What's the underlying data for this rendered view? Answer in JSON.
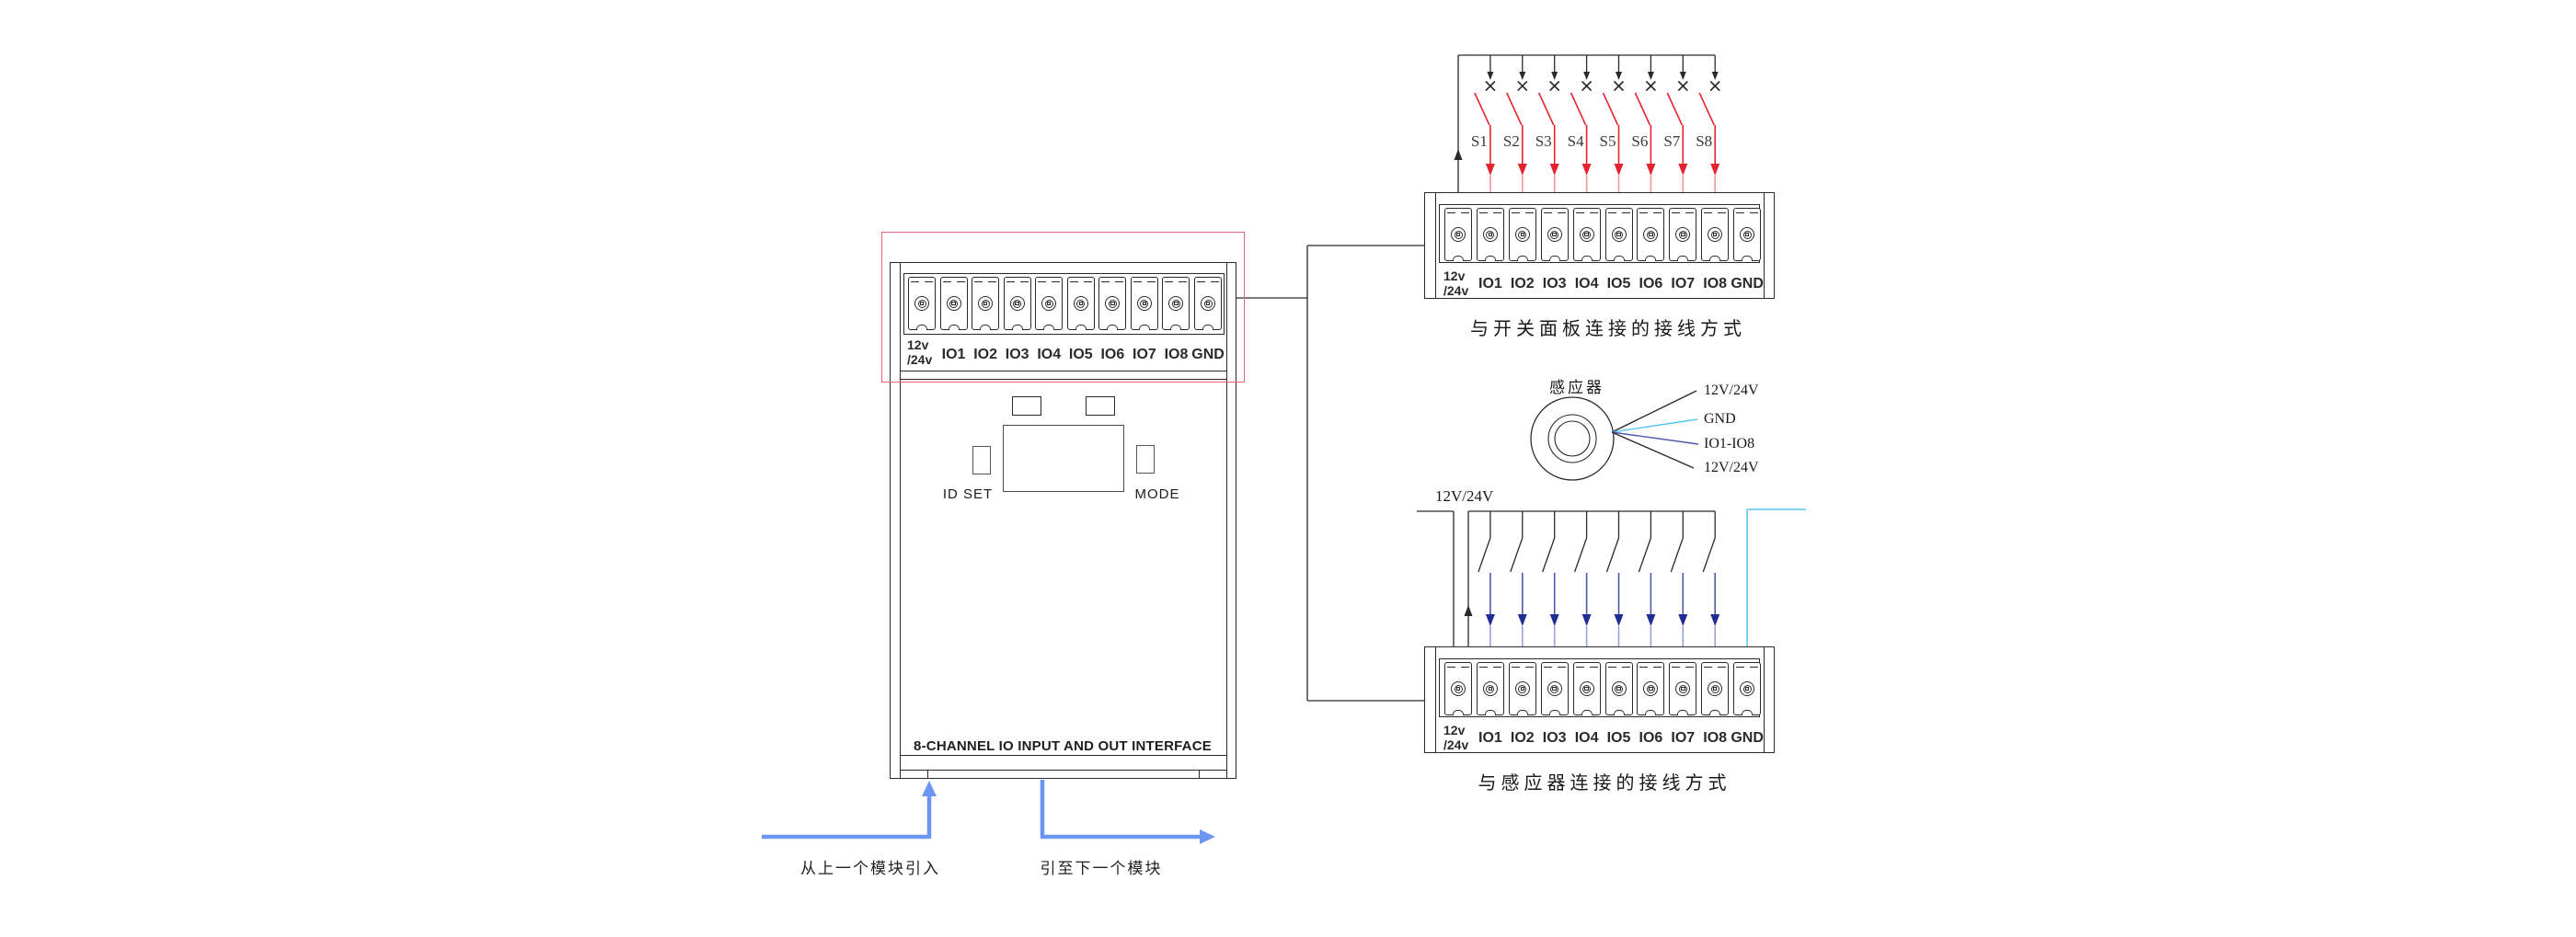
{
  "diagram": {
    "module": {
      "power_label_top": "12v",
      "power_label_bottom": "/24v",
      "io_labels": [
        "IO1",
        "IO2",
        "IO3",
        "IO4",
        "IO5",
        "IO6",
        "IO7",
        "IO8"
      ],
      "gnd_label": "GND",
      "id_set_label": "ID SET",
      "mode_label": "MODE",
      "bottom_label": "8-CHANNEL IO INPUT AND OUT INTERFACE"
    },
    "switch_panel": {
      "caption": "与开关面板连接的接线方式",
      "switch_labels": [
        "S1",
        "S2",
        "S3",
        "S4",
        "S5",
        "S6",
        "S7",
        "S8"
      ]
    },
    "sensor_panel": {
      "caption": "与感应器连接的接线方式",
      "bus_label": "12V/24V",
      "sensor_label": "感应器",
      "wire_labels": [
        "12V/24V",
        "GND",
        "IO1-IO8",
        "12V/24V"
      ]
    },
    "flow": {
      "in_label": "从上一个模块引入",
      "out_label": "引至下一个模块"
    },
    "colors": {
      "line": "#2b2a29",
      "red_wire": "#e5232e",
      "light_red": "#f0959c",
      "navy_wire": "#4d58ab",
      "navy_arrow": "#1f2d92",
      "light_navy": "#9aa2d8",
      "cyan_wire": "#55c6f1",
      "flow_blue": "#6d96f3",
      "highlight_red": "#e8636b"
    }
  }
}
